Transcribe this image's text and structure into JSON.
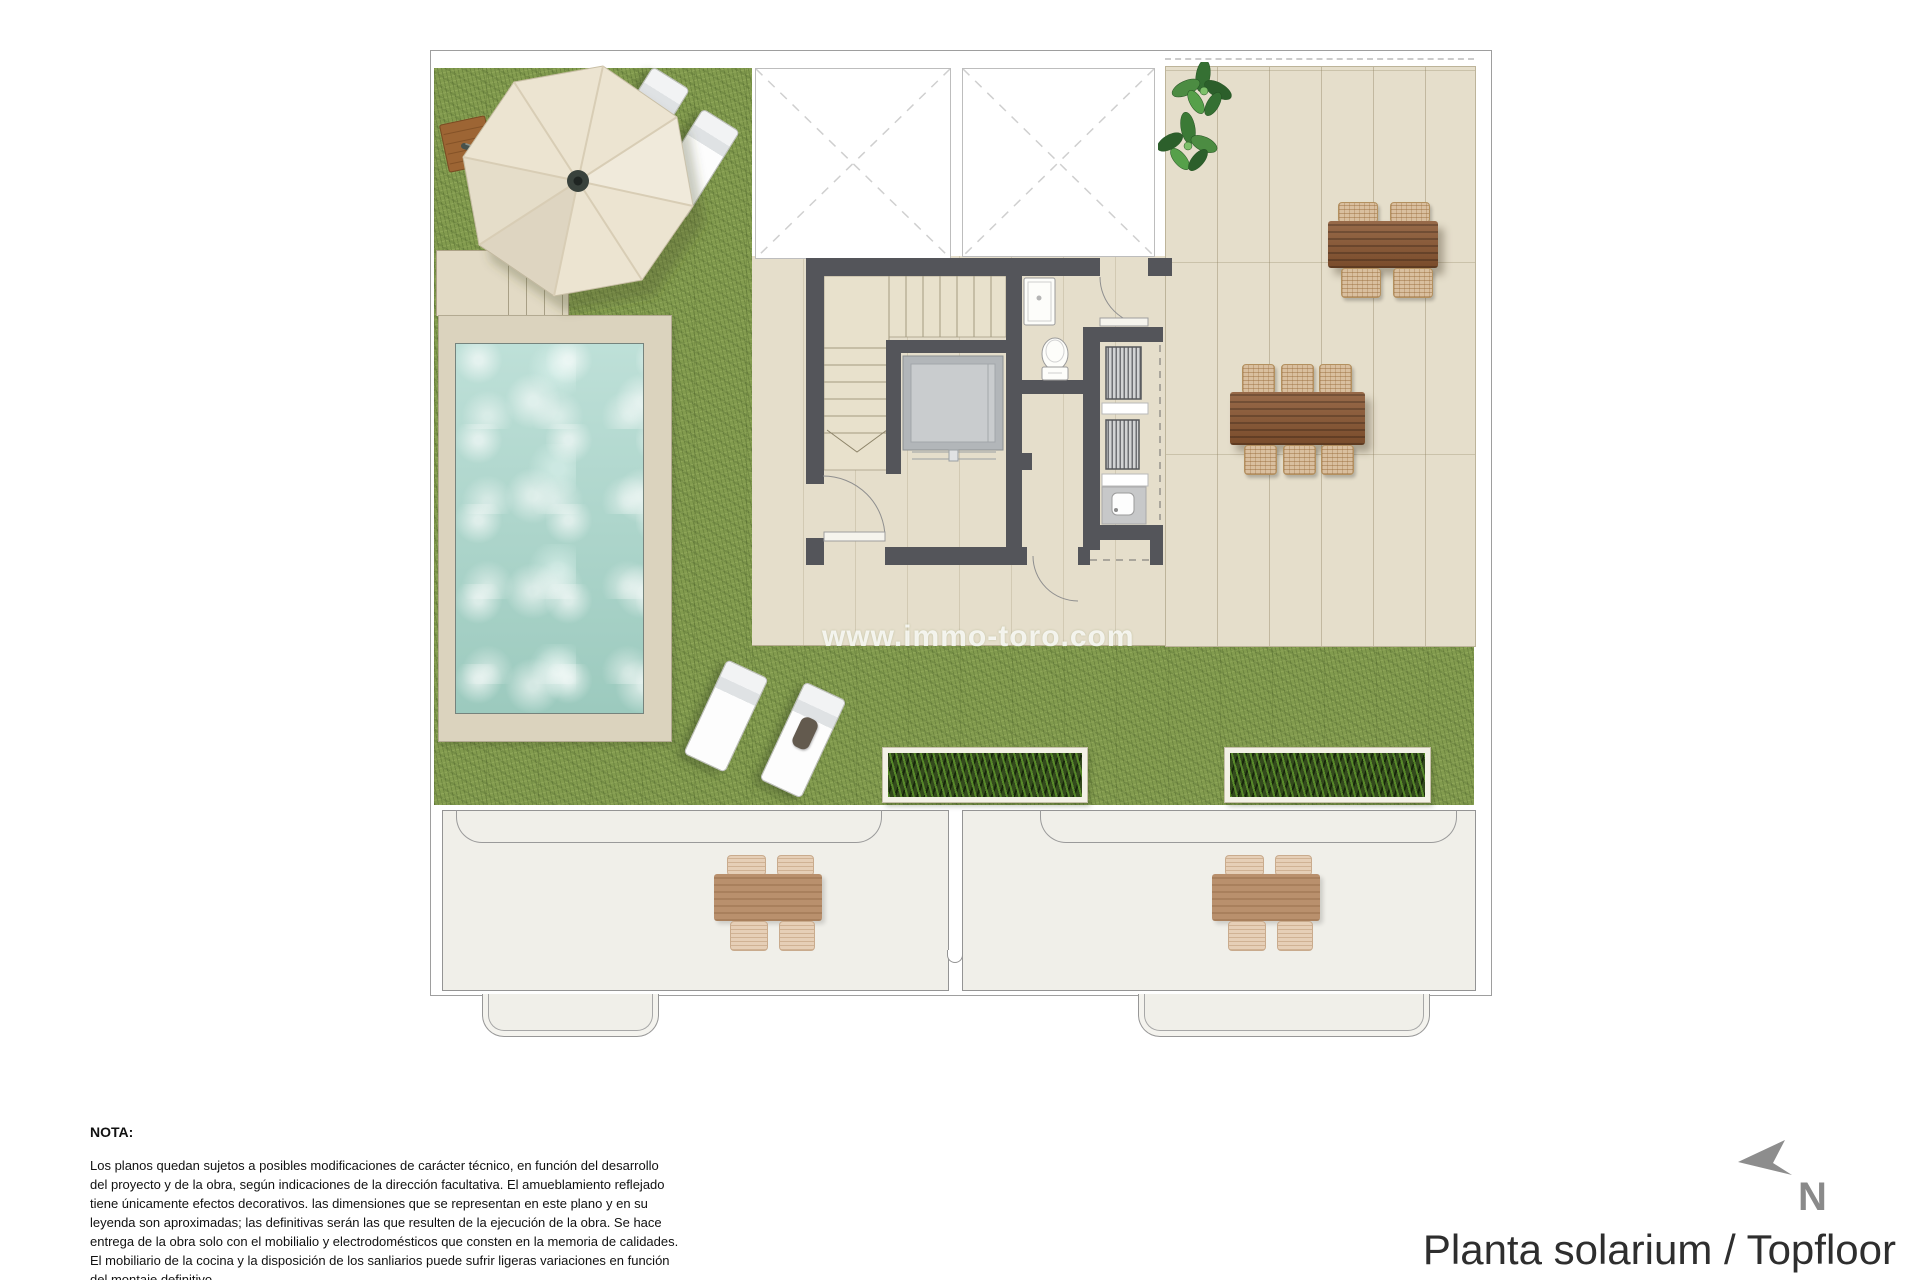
{
  "document": {
    "title": "Planta solarium / Topfloor",
    "watermark": "www.immo-toro.com",
    "compass_label": "N",
    "note": {
      "heading": "NOTA:",
      "body": "Los planos quedan sujetos a posibles modificaciones de carácter técnico, en función del desarrollo\ndel proyecto y de la obra, según indicaciones de la dirección facultativa. El amueblamiento reflejado\ntiene únicamente efectos decorativos. las dimensiones que se representan en este plano y en su\nleyenda son aproximadas; las definitivas serán las que resulten de la ejecución de la obra. Se hace\nentrega de la obra solo con el mobilialio y electrodomésticos que consten en la memoria de calidades.\nEl mobiliario de la cocina y la disposición de los sanliarios puede sufrir ligeras variaciones en función\ndel montaje definitivo."
    }
  },
  "palette": {
    "grass": "#829b4e",
    "floor_beige": "#e5decb",
    "pool_water": "#a5d0c7",
    "pool_deck": "#dbd3be",
    "wall_dark": "#54555a",
    "wood_table": "#8a5631",
    "wicker_chair": "#d9bf9f",
    "ghost_outline": "#949494",
    "compass_gray": "#8d8d8d"
  },
  "plan": {
    "level_name": "Planta solarium / Topfloor",
    "features": [
      "parasol",
      "parasol-wood-base",
      "sun-loungers",
      "plunge-pool",
      "lawn",
      "access-stairs",
      "stair-core",
      "elevator",
      "shower",
      "toilet",
      "louver-units",
      "sink",
      "dining-table-6-seats",
      "dining-table-4-seats",
      "potted-plants",
      "grass-planters",
      "roof-voids",
      "lower-floor-terraces",
      "lower-floor-tables"
    ]
  }
}
